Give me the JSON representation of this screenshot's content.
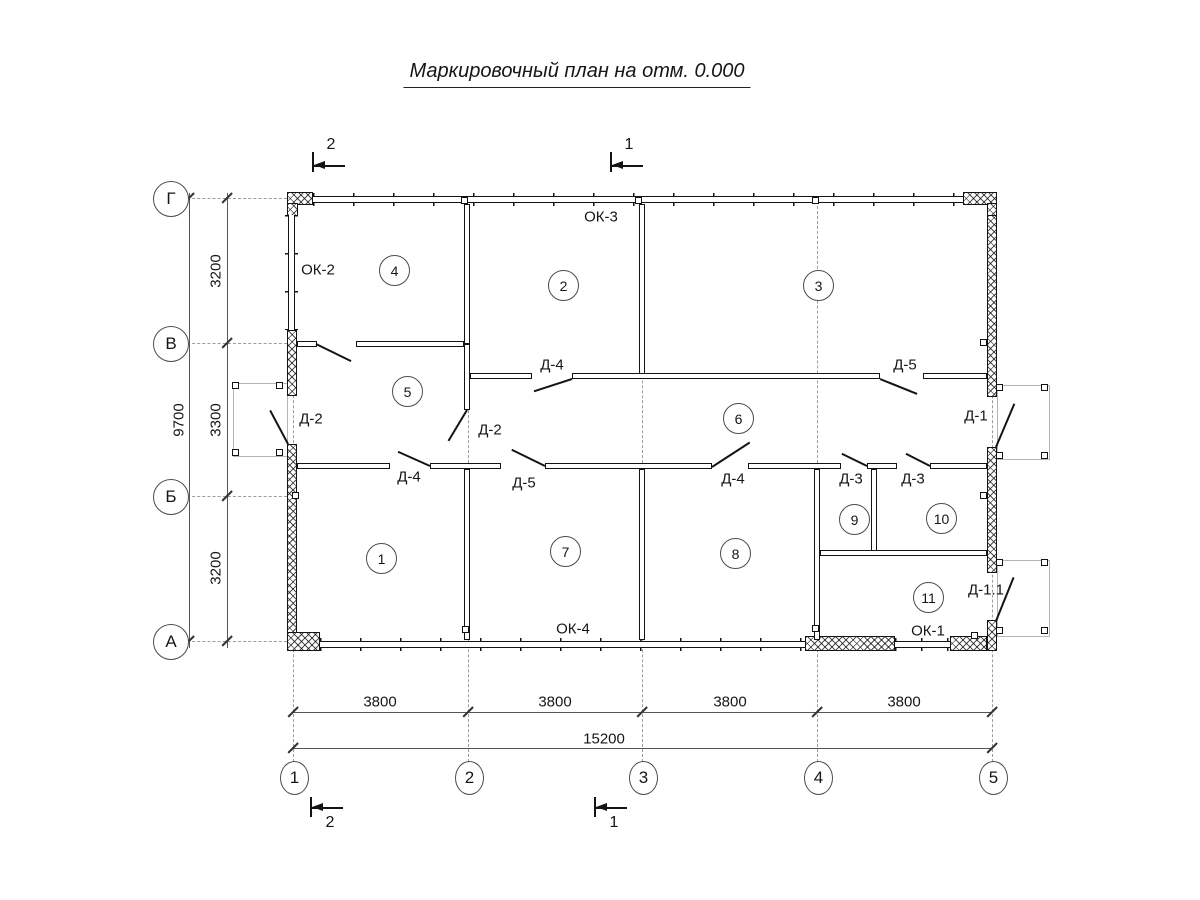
{
  "title": "Маркировочный план на отм. 0.000",
  "grid": {
    "rows": [
      "Г",
      "В",
      "Б",
      "А"
    ],
    "cols": [
      "1",
      "2",
      "3",
      "4",
      "5"
    ]
  },
  "dimensions": {
    "vertical": [
      "3200",
      "3300",
      "3200"
    ],
    "vertical_total": "9700",
    "horizontal": [
      "3800",
      "3800",
      "3800",
      "3800"
    ],
    "horizontal_total": "15200"
  },
  "rooms": [
    "1",
    "2",
    "3",
    "4",
    "5",
    "6",
    "7",
    "8",
    "9",
    "10",
    "11"
  ],
  "windows": {
    "ok1": "ОК-1",
    "ok2": "ОК-2",
    "ok3": "ОК-3",
    "ok4": "ОК-4"
  },
  "doors": {
    "d1": "Д-1",
    "d11": "Д-1.1",
    "d2": "Д-2",
    "d3": "Д-3",
    "d4": "Д-4",
    "d5": "Д-5"
  },
  "sections": {
    "top": [
      "2",
      "1"
    ],
    "bottom": [
      "2",
      "1"
    ]
  }
}
